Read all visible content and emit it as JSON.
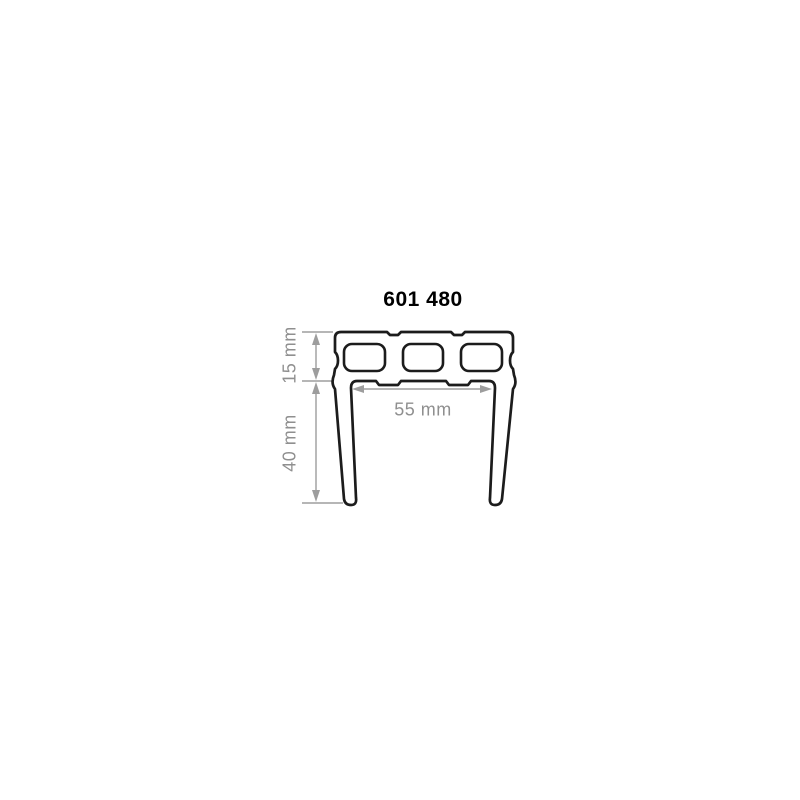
{
  "page": {
    "background": "#ffffff"
  },
  "drawing": {
    "title": "601 480",
    "dimensions": [
      {
        "name": "top-section-height",
        "label": "15 mm",
        "value": 15,
        "unit": "mm",
        "orientation": "vertical"
      },
      {
        "name": "leg-length",
        "label": "40 mm",
        "value": 40,
        "unit": "mm",
        "orientation": "vertical"
      },
      {
        "name": "inner-width",
        "label": "55 mm",
        "value": 55,
        "unit": "mm",
        "orientation": "horizontal"
      }
    ],
    "profile": {
      "chamber_count": 3,
      "description": "U-shaped extrusion profile cross-section: top bar with three rounded rectangular hollow chambers and two slightly converging downward legs"
    },
    "colors": {
      "outline": "#1c1c1c",
      "dimension_lines": "#9d9d9d",
      "dimension_text": "#8f8f8f",
      "title_text": "#000000",
      "background": "#ffffff"
    }
  }
}
